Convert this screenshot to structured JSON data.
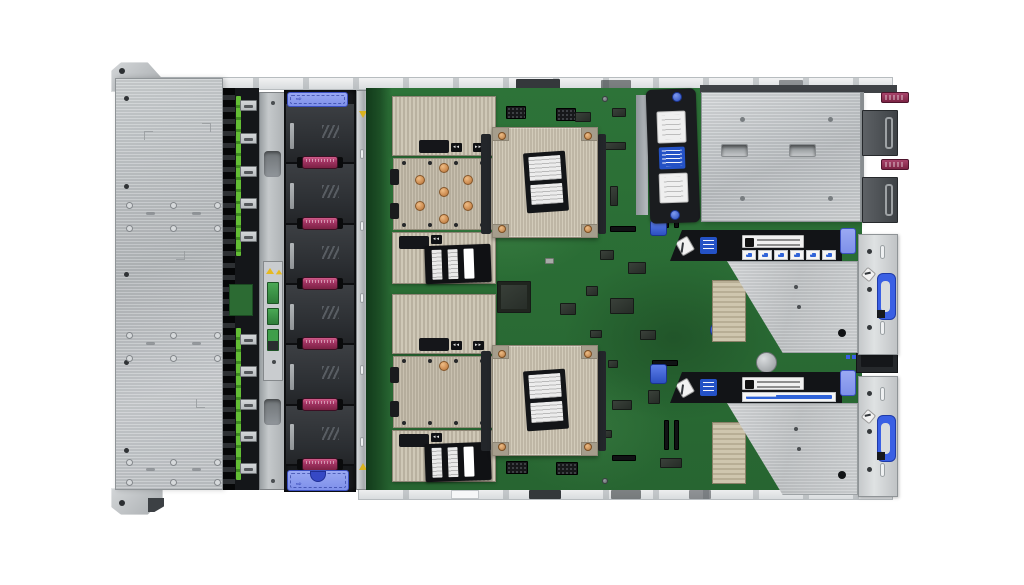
{
  "meta": {
    "title": "Rack server internal top view",
    "description": "Top-down product photo of a 2U rack server with cover removed: front drive backplane, bank of six hot-swap fans, two CPU heatsinks and two open processor sockets on a green motherboard, dual power supplies and two PCIe riser cages at the rear.",
    "background": "#ffffff"
  },
  "palette": {
    "chassis_silver": "#c9ccce",
    "board_green": "#2a6f36",
    "fan_dark": "#303337",
    "latch_blue": "#8b9cee",
    "accent_blue": "#2a53c9",
    "handle_maroon": "#8e2c4f",
    "heatsink_beige": "#c9c1b0",
    "copper": "#d69a60",
    "warning_yellow": "#e6b91e"
  },
  "front": {
    "plate": {
      "screw_count": 5,
      "ring_cols": 3,
      "ring_rows": 6
    },
    "backplane": {
      "connector_groups": 2,
      "connectors_per_group": 5
    },
    "bracket": {
      "green_sticker_count": 3,
      "warning_icon_count": 2
    }
  },
  "fans": {
    "count": 6,
    "latch_arrow": "⇨",
    "handle_color": "#8e2c4f",
    "latch_count": 2
  },
  "cpu": {
    "bank_count": 2,
    "socket_pad_count": 7,
    "heatsink_count": 2,
    "tag_left": "◂◂",
    "tag_right": "▸▸",
    "heatsink_label_cards": 2
  },
  "risers": {
    "cage_count": 2,
    "icon_tiles": 6,
    "rail_ovals": 3,
    "rail_dots": 3,
    "warning_label_lines": 2,
    "handle_color": "#3a60e4"
  },
  "psu": {
    "count": 2,
    "pull_tab_color": "#8c2a4c"
  },
  "board": {
    "battery_count": 1,
    "blue_thumbscrew_count": 1
  }
}
